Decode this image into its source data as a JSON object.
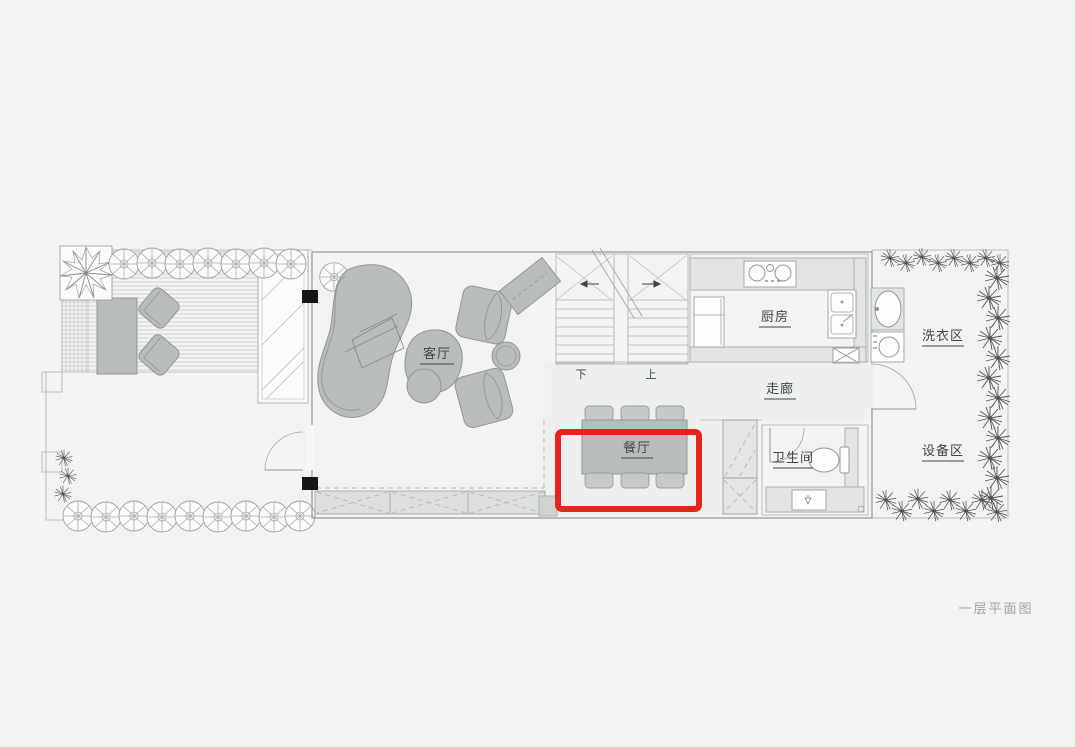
{
  "title": {
    "caption": "一层平面图"
  },
  "rooms": {
    "living": {
      "label": "客厅"
    },
    "dining": {
      "label": "餐厅"
    },
    "kitchen": {
      "label": "厨房"
    },
    "corridor": {
      "label": "走廊"
    },
    "bathroom": {
      "label": "卫生间"
    },
    "laundry": {
      "label": "洗衣区"
    },
    "equipment": {
      "label": "设备区"
    }
  },
  "stairs": {
    "down_label": "下",
    "up_label": "上"
  },
  "annotation": {
    "highlight_color": "#e8231c",
    "highlighted_room": "餐厅"
  },
  "colors": {
    "background": "#f3f4f2",
    "floor_white": "#fcfcfb",
    "floor_gray": "#eef0ee",
    "furniture_gray": "#b9bdba",
    "counter_gray": "#e2e4e2",
    "wall_line": "#8f9694",
    "text_dark": "#3d4644",
    "caption_gray": "#9aa4a1"
  }
}
